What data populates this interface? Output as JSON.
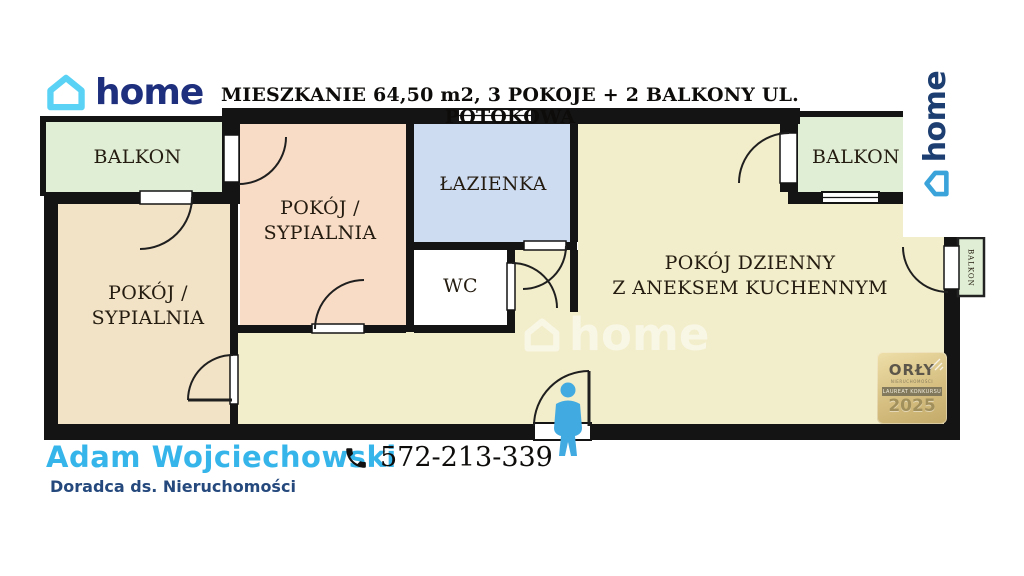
{
  "brand": {
    "logo_text": "home"
  },
  "side_logo": {
    "text": "home"
  },
  "header": {
    "title": "MIESZKANIE 64,50 m2, 3  POKOJE + 2 BALKONY UL. POTOKOWA"
  },
  "rooms": {
    "balcony_left": "BALKON",
    "bedroom_left_line1": "POKÓJ /",
    "bedroom_left_line2": "SYPIALNIA",
    "bedroom_pink_line1": "POKÓJ /",
    "bedroom_pink_line2": "SYPIALNIA",
    "bathroom": "ŁAZIENKA",
    "wc": "WC",
    "living_line1": "POKÓJ DZIENNY",
    "living_line2": "Z ANEKSEM KUCHENNYM",
    "balcony_right": "BALKON",
    "balcony_small": "BALKON"
  },
  "watermark": {
    "text": "home"
  },
  "badge": {
    "line1": "ORŁY",
    "line2": "NIERUCHOMOŚCI",
    "line3": "LAUREAT KONKURSU",
    "year": "2025"
  },
  "agent": {
    "name": "Adam Wojciechowski",
    "role": "Doradca ds. Nieruchomości",
    "phone": "572-213-339"
  },
  "colors": {
    "brand_navy": "#1e2f7e",
    "brand_cyan": "#59d2f5",
    "side_logo_blue": "#3aa3da",
    "agent_blue": "#36b5ea",
    "agent_navy": "#25497d",
    "wall": "#141414",
    "balcony_green": "#dfeed4",
    "bedroom_tan": "#f3e3c6",
    "bedroom_peach": "#f9dcc6",
    "bathroom_blue": "#cedcf2",
    "living_beige": "#f2edca",
    "badge_gold": "#d6bf81",
    "person_blue": "#41aae0"
  }
}
